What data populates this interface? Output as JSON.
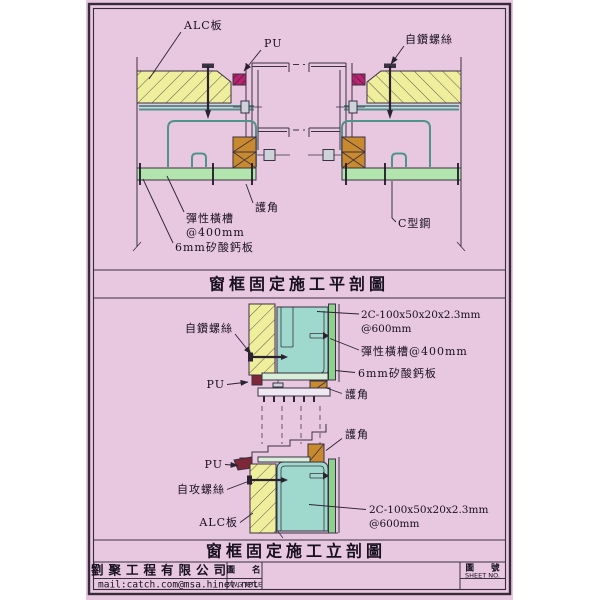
{
  "sheet": {
    "type": "construction-detail-drawing",
    "colors": {
      "sheet_background": "#e8c7e0",
      "border": "#372b3b",
      "alc_panel_yellow": "#efee9d",
      "steel_channel_teal": "#9fd8cc",
      "board_green": "#b2e5ae",
      "board_green_dark": "#8cd28c",
      "wood_brown": "#c8892f",
      "pu_magenta": "#b3256e",
      "pu_dark_maroon": "#7e2738"
    }
  },
  "top_section": {
    "title": "窗框固定施工平剖圖",
    "labels": {
      "alc_board": "ALC板",
      "pu": "PU",
      "self_drilling_screw": "自鑽螺絲",
      "elastic_channel_line1": "彈性橫槽",
      "elastic_channel_line2": "@400mm",
      "corner_guard": "護角",
      "c_channel": "C型鋼",
      "calcium_silicate_board": "6mm矽酸鈣板"
    }
  },
  "bottom_section": {
    "title": "窗框固定施工立剖圖",
    "labels": {
      "self_drilling_screw": "自鑽螺絲",
      "pu_top": "PU",
      "c_channel_spec_line1": "2C-100x50x20x2.3mm",
      "c_channel_spec_line2": "@600mm",
      "elastic_channel": "彈性橫槽@400mm",
      "calcium_silicate_board": "6mm矽酸鈣板",
      "corner_guard_upper": "護角",
      "corner_guard_lower": "護角",
      "pu_bottom": "PU",
      "self_tapping_screw": "自攻螺絲",
      "alc_board": "ALC板",
      "c_channel_spec2_line1": "2C-100x50x20x2.3mm",
      "c_channel_spec2_line2": "@600mm"
    }
  },
  "title_block": {
    "company": "劉聚工程有限公司",
    "email": "mail:catch.com@msa.hinet.net",
    "dwg_title_label_zh": "圖 名",
    "dwg_title_label_en": "DWG TITLE",
    "dwg_title_value": "",
    "sheet_no_label_zh": "圖 號",
    "sheet_no_label_en": "SHEET NO.",
    "sheet_no_value": ""
  }
}
